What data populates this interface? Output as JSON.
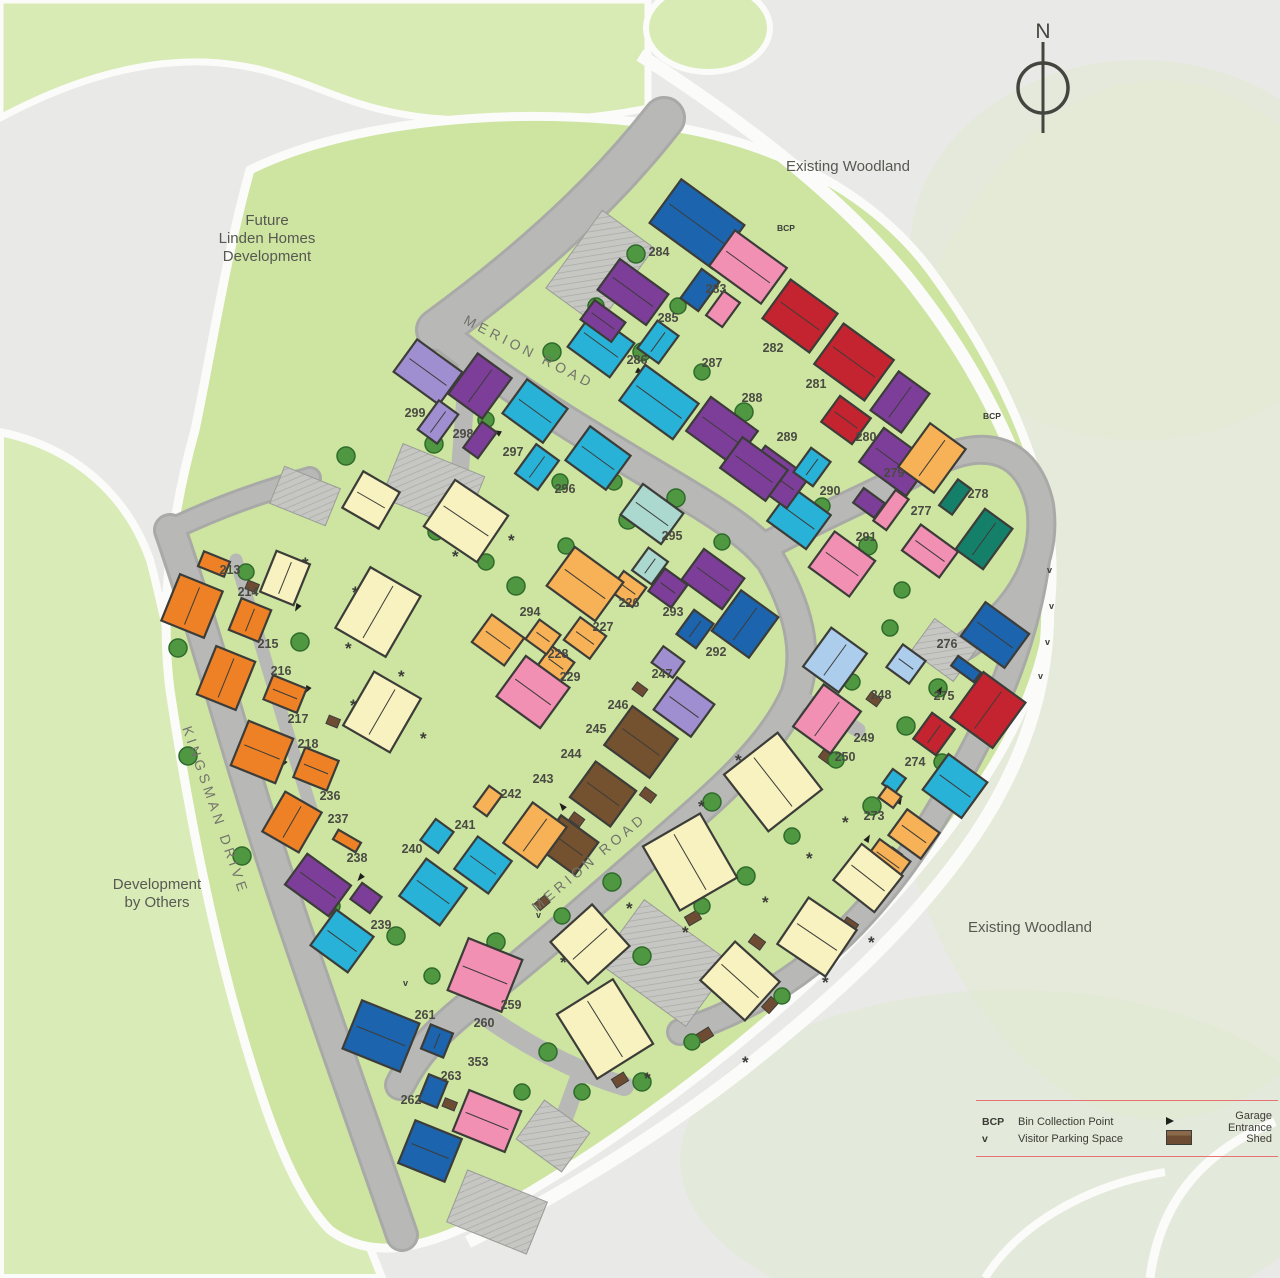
{
  "map": {
    "colors": {
      "orange": "#ee8125",
      "amber": "#f7b157",
      "cream": "#f8f2c0",
      "pink": "#f290b3",
      "red": "#c3242f",
      "purple": "#7c3e99",
      "lavender": "#a08fd0",
      "cyan": "#29b2d8",
      "paleCyan": "#abd9cf",
      "blue": "#1c64ad",
      "lightBlue": "#accdec",
      "teal": "#15806a",
      "brown": "#74512f",
      "road": "#b6b7b4",
      "green_dev": "#cde5a1",
      "green_band": "#d8ebb4",
      "legend_rule": "#e87272"
    },
    "compass": {
      "label": "N"
    },
    "area_labels": [
      {
        "id": "existing-woodland-top",
        "lines": [
          "Existing Woodland"
        ],
        "x": 848,
        "y": 171
      },
      {
        "id": "existing-woodland-right",
        "lines": [
          "Existing Woodland"
        ],
        "x": 1030,
        "y": 932
      },
      {
        "id": "future-linden-homes",
        "lines": [
          "Future",
          "Linden Homes",
          "Development"
        ],
        "x": 267,
        "y": 225
      },
      {
        "id": "development-by-others",
        "lines": [
          "Development",
          "by Others"
        ],
        "x": 157,
        "y": 889
      }
    ],
    "road_labels": [
      {
        "text": "MERION ROAD",
        "x": 527,
        "y": 356,
        "angle": 27
      },
      {
        "text": "MERION ROAD",
        "x": 592,
        "y": 866,
        "angle": -40
      },
      {
        "text": "KINGSMAN DRIVE",
        "x": 211,
        "y": 812,
        "angle": 71
      }
    ],
    "poi_labels": [
      {
        "text": "BCP",
        "x": 992,
        "y": 419
      },
      {
        "text": "BCP",
        "x": 786,
        "y": 231
      }
    ],
    "plot_labels": [
      {
        "n": "213",
        "x": 230,
        "y": 574
      },
      {
        "n": "214",
        "x": 248,
        "y": 596
      },
      {
        "n": "215",
        "x": 268,
        "y": 648
      },
      {
        "n": "216",
        "x": 281,
        "y": 675
      },
      {
        "n": "217",
        "x": 298,
        "y": 723
      },
      {
        "n": "218",
        "x": 308,
        "y": 748
      },
      {
        "n": "226",
        "x": 629,
        "y": 607
      },
      {
        "n": "227",
        "x": 603,
        "y": 631
      },
      {
        "n": "228",
        "x": 558,
        "y": 658
      },
      {
        "n": "229",
        "x": 570,
        "y": 681
      },
      {
        "n": "236",
        "x": 330,
        "y": 800
      },
      {
        "n": "237",
        "x": 338,
        "y": 823
      },
      {
        "n": "238",
        "x": 357,
        "y": 862
      },
      {
        "n": "239",
        "x": 381,
        "y": 929
      },
      {
        "n": "240",
        "x": 412,
        "y": 853
      },
      {
        "n": "241",
        "x": 465,
        "y": 829
      },
      {
        "n": "242",
        "x": 511,
        "y": 798
      },
      {
        "n": "243",
        "x": 543,
        "y": 783
      },
      {
        "n": "244",
        "x": 571,
        "y": 758
      },
      {
        "n": "245",
        "x": 596,
        "y": 733
      },
      {
        "n": "246",
        "x": 618,
        "y": 709
      },
      {
        "n": "247",
        "x": 662,
        "y": 678
      },
      {
        "n": "248",
        "x": 881,
        "y": 699
      },
      {
        "n": "249",
        "x": 864,
        "y": 742
      },
      {
        "n": "250",
        "x": 845,
        "y": 761
      },
      {
        "n": "259",
        "x": 511,
        "y": 1009
      },
      {
        "n": "260",
        "x": 484,
        "y": 1027
      },
      {
        "n": "261",
        "x": 425,
        "y": 1019
      },
      {
        "n": "262",
        "x": 411,
        "y": 1104
      },
      {
        "n": "263",
        "x": 451,
        "y": 1080
      },
      {
        "n": "353",
        "x": 478,
        "y": 1066
      },
      {
        "n": "273",
        "x": 874,
        "y": 820
      },
      {
        "n": "274",
        "x": 915,
        "y": 766
      },
      {
        "n": "275",
        "x": 944,
        "y": 700
      },
      {
        "n": "276",
        "x": 947,
        "y": 648
      },
      {
        "n": "277",
        "x": 921,
        "y": 515
      },
      {
        "n": "278",
        "x": 978,
        "y": 498
      },
      {
        "n": "279",
        "x": 894,
        "y": 477
      },
      {
        "n": "280",
        "x": 866,
        "y": 441
      },
      {
        "n": "281",
        "x": 816,
        "y": 388
      },
      {
        "n": "282",
        "x": 773,
        "y": 352
      },
      {
        "n": "283",
        "x": 716,
        "y": 293
      },
      {
        "n": "284",
        "x": 659,
        "y": 256
      },
      {
        "n": "285",
        "x": 668,
        "y": 322
      },
      {
        "n": "286",
        "x": 637,
        "y": 364
      },
      {
        "n": "287",
        "x": 712,
        "y": 367
      },
      {
        "n": "288",
        "x": 752,
        "y": 402
      },
      {
        "n": "289",
        "x": 787,
        "y": 441
      },
      {
        "n": "290",
        "x": 830,
        "y": 495
      },
      {
        "n": "291",
        "x": 866,
        "y": 541
      },
      {
        "n": "292",
        "x": 716,
        "y": 656
      },
      {
        "n": "293",
        "x": 673,
        "y": 616
      },
      {
        "n": "294",
        "x": 530,
        "y": 616
      },
      {
        "n": "295",
        "x": 672,
        "y": 540
      },
      {
        "n": "296",
        "x": 565,
        "y": 493
      },
      {
        "n": "297",
        "x": 513,
        "y": 456
      },
      {
        "n": "298",
        "x": 463,
        "y": 438
      },
      {
        "n": "299",
        "x": 415,
        "y": 417
      }
    ],
    "houses": [
      {
        "x": 697,
        "y": 224,
        "w": 78,
        "h": 54,
        "r": 36,
        "c": "blue"
      },
      {
        "x": 700,
        "y": 290,
        "w": 22,
        "h": 36,
        "r": 36,
        "c": "blue"
      },
      {
        "x": 723,
        "y": 309,
        "w": 20,
        "h": 30,
        "r": 36,
        "c": "pink"
      },
      {
        "x": 748,
        "y": 267,
        "w": 64,
        "h": 44,
        "r": 36,
        "c": "pink"
      },
      {
        "x": 800,
        "y": 316,
        "w": 58,
        "h": 48,
        "r": 36,
        "c": "red"
      },
      {
        "x": 854,
        "y": 362,
        "w": 62,
        "h": 50,
        "r": 36,
        "c": "red"
      },
      {
        "x": 846,
        "y": 420,
        "w": 38,
        "h": 32,
        "r": 36,
        "c": "red"
      },
      {
        "x": 900,
        "y": 402,
        "w": 38,
        "h": 48,
        "r": 36,
        "c": "purple"
      },
      {
        "x": 895,
        "y": 462,
        "w": 58,
        "h": 42,
        "r": 36,
        "c": "purple"
      },
      {
        "x": 869,
        "y": 503,
        "w": 26,
        "h": 18,
        "r": 36,
        "c": "purple"
      },
      {
        "x": 932,
        "y": 458,
        "w": 44,
        "h": 54,
        "r": 36,
        "c": "amber"
      },
      {
        "x": 955,
        "y": 497,
        "w": 16,
        "h": 32,
        "r": 36,
        "c": "teal"
      },
      {
        "x": 984,
        "y": 539,
        "w": 34,
        "h": 50,
        "r": 36,
        "c": "teal"
      },
      {
        "x": 891,
        "y": 510,
        "w": 16,
        "h": 38,
        "r": 36,
        "c": "pink"
      },
      {
        "x": 930,
        "y": 551,
        "w": 46,
        "h": 32,
        "r": 36,
        "c": "pink"
      },
      {
        "x": 842,
        "y": 564,
        "w": 50,
        "h": 44,
        "r": 36,
        "c": "pink"
      },
      {
        "x": 799,
        "y": 518,
        "w": 48,
        "h": 42,
        "r": 36,
        "c": "cyan"
      },
      {
        "x": 776,
        "y": 477,
        "w": 54,
        "h": 38,
        "r": 36,
        "c": "purple"
      },
      {
        "x": 812,
        "y": 467,
        "w": 24,
        "h": 30,
        "r": 36,
        "c": "cyan"
      },
      {
        "x": 722,
        "y": 431,
        "w": 58,
        "h": 42,
        "r": 36,
        "c": "purple"
      },
      {
        "x": 754,
        "y": 469,
        "w": 56,
        "h": 38,
        "r": 36,
        "c": "purple"
      },
      {
        "x": 659,
        "y": 402,
        "w": 66,
        "h": 44,
        "r": 36,
        "c": "cyan"
      },
      {
        "x": 601,
        "y": 345,
        "w": 52,
        "h": 42,
        "r": 36,
        "c": "cyan"
      },
      {
        "x": 658,
        "y": 342,
        "w": 26,
        "h": 34,
        "r": 36,
        "c": "cyan"
      },
      {
        "x": 633,
        "y": 292,
        "w": 60,
        "h": 38,
        "r": 36,
        "c": "purple"
      },
      {
        "x": 603,
        "y": 321,
        "w": 38,
        "h": 24,
        "r": 36,
        "c": "purple"
      },
      {
        "x": 428,
        "y": 372,
        "w": 56,
        "h": 40,
        "r": 36,
        "c": "lavender"
      },
      {
        "x": 438,
        "y": 422,
        "w": 24,
        "h": 36,
        "r": 36,
        "c": "lavender"
      },
      {
        "x": 480,
        "y": 386,
        "w": 42,
        "h": 50,
        "r": 36,
        "c": "purple"
      },
      {
        "x": 480,
        "y": 440,
        "w": 18,
        "h": 32,
        "r": 36,
        "c": "purple"
      },
      {
        "x": 535,
        "y": 411,
        "w": 50,
        "h": 42,
        "r": 36,
        "c": "cyan"
      },
      {
        "x": 537,
        "y": 467,
        "w": 28,
        "h": 36,
        "r": 36,
        "c": "cyan"
      },
      {
        "x": 598,
        "y": 458,
        "w": 50,
        "h": 42,
        "r": 36,
        "c": "cyan"
      },
      {
        "x": 652,
        "y": 514,
        "w": 50,
        "h": 38,
        "r": 36,
        "c": "paleCyan"
      },
      {
        "x": 650,
        "y": 566,
        "w": 24,
        "h": 28,
        "r": 36,
        "c": "paleCyan"
      },
      {
        "x": 628,
        "y": 589,
        "w": 28,
        "h": 24,
        "r": 36,
        "c": "amber"
      },
      {
        "x": 585,
        "y": 584,
        "w": 60,
        "h": 48,
        "r": 36,
        "c": "amber"
      },
      {
        "x": 585,
        "y": 638,
        "w": 32,
        "h": 28,
        "r": 36,
        "c": "amber"
      },
      {
        "x": 556,
        "y": 664,
        "w": 28,
        "h": 24,
        "r": 36,
        "c": "amber"
      },
      {
        "x": 543,
        "y": 637,
        "w": 26,
        "h": 24,
        "r": 36,
        "c": "amber"
      },
      {
        "x": 533,
        "y": 692,
        "w": 54,
        "h": 50,
        "r": 36,
        "c": "pink"
      },
      {
        "x": 498,
        "y": 640,
        "w": 40,
        "h": 34,
        "r": 36,
        "c": "amber"
      },
      {
        "x": 713,
        "y": 579,
        "w": 50,
        "h": 38,
        "r": 36,
        "c": "purple"
      },
      {
        "x": 668,
        "y": 588,
        "w": 28,
        "h": 28,
        "r": 36,
        "c": "purple"
      },
      {
        "x": 695,
        "y": 629,
        "w": 24,
        "h": 30,
        "r": 36,
        "c": "blue"
      },
      {
        "x": 745,
        "y": 624,
        "w": 46,
        "h": 50,
        "r": 36,
        "c": "blue"
      },
      {
        "x": 668,
        "y": 662,
        "w": 26,
        "h": 20,
        "r": 36,
        "c": "lavender"
      },
      {
        "x": 684,
        "y": 707,
        "w": 46,
        "h": 40,
        "r": 36,
        "c": "lavender"
      },
      {
        "x": 641,
        "y": 742,
        "w": 56,
        "h": 48,
        "r": 36,
        "c": "brown"
      },
      {
        "x": 603,
        "y": 794,
        "w": 50,
        "h": 44,
        "r": 36,
        "c": "brown"
      },
      {
        "x": 568,
        "y": 845,
        "w": 46,
        "h": 40,
        "r": 36,
        "c": "brown"
      },
      {
        "x": 535,
        "y": 835,
        "w": 42,
        "h": 50,
        "r": 36,
        "c": "amber"
      },
      {
        "x": 488,
        "y": 801,
        "w": 16,
        "h": 26,
        "r": 36,
        "c": "amber"
      },
      {
        "x": 437,
        "y": 836,
        "w": 22,
        "h": 26,
        "r": 36,
        "c": "cyan"
      },
      {
        "x": 483,
        "y": 865,
        "w": 42,
        "h": 40,
        "r": 36,
        "c": "cyan"
      },
      {
        "x": 433,
        "y": 892,
        "w": 50,
        "h": 46,
        "r": 36,
        "c": "cyan"
      },
      {
        "x": 342,
        "y": 941,
        "w": 46,
        "h": 44,
        "r": 36,
        "c": "cyan"
      },
      {
        "x": 318,
        "y": 885,
        "w": 54,
        "h": 38,
        "r": 36,
        "c": "purple"
      },
      {
        "x": 366,
        "y": 898,
        "w": 24,
        "h": 20,
        "r": 36,
        "c": "purple"
      },
      {
        "x": 347,
        "y": 841,
        "w": 26,
        "h": 11,
        "r": 30,
        "c": "orange"
      },
      {
        "x": 292,
        "y": 822,
        "w": 42,
        "h": 46,
        "r": 30,
        "c": "orange"
      },
      {
        "x": 214,
        "y": 564,
        "w": 28,
        "h": 16,
        "r": 22,
        "c": "orange"
      },
      {
        "x": 192,
        "y": 606,
        "w": 46,
        "h": 50,
        "r": 22,
        "c": "orange"
      },
      {
        "x": 250,
        "y": 620,
        "w": 32,
        "h": 34,
        "r": 22,
        "c": "orange"
      },
      {
        "x": 226,
        "y": 678,
        "w": 42,
        "h": 52,
        "r": 22,
        "c": "orange"
      },
      {
        "x": 285,
        "y": 694,
        "w": 36,
        "h": 26,
        "r": 22,
        "c": "orange"
      },
      {
        "x": 262,
        "y": 752,
        "w": 48,
        "h": 48,
        "r": 22,
        "c": "orange"
      },
      {
        "x": 316,
        "y": 769,
        "w": 36,
        "h": 32,
        "r": 22,
        "c": "orange"
      },
      {
        "x": 285,
        "y": 578,
        "w": 36,
        "h": 44,
        "r": 22,
        "c": "cream"
      },
      {
        "x": 371,
        "y": 500,
        "w": 42,
        "h": 42,
        "r": 30,
        "c": "cream"
      },
      {
        "x": 466,
        "y": 521,
        "w": 64,
        "h": 56,
        "r": 34,
        "c": "cream"
      },
      {
        "x": 378,
        "y": 612,
        "w": 58,
        "h": 70,
        "r": 30,
        "c": "cream"
      },
      {
        "x": 382,
        "y": 712,
        "w": 54,
        "h": 62,
        "r": 30,
        "c": "cream"
      },
      {
        "x": 835,
        "y": 660,
        "w": 44,
        "h": 48,
        "r": 36,
        "c": "lightBlue"
      },
      {
        "x": 906,
        "y": 664,
        "w": 28,
        "h": 28,
        "r": 36,
        "c": "lightBlue"
      },
      {
        "x": 827,
        "y": 719,
        "w": 46,
        "h": 52,
        "r": 36,
        "c": "pink"
      },
      {
        "x": 934,
        "y": 734,
        "w": 28,
        "h": 32,
        "r": 36,
        "c": "red"
      },
      {
        "x": 988,
        "y": 710,
        "w": 52,
        "h": 56,
        "r": 36,
        "c": "red"
      },
      {
        "x": 955,
        "y": 786,
        "w": 48,
        "h": 44,
        "r": 36,
        "c": "cyan"
      },
      {
        "x": 894,
        "y": 781,
        "w": 16,
        "h": 18,
        "r": 36,
        "c": "cyan"
      },
      {
        "x": 890,
        "y": 797,
        "w": 18,
        "h": 14,
        "r": 36,
        "c": "amber"
      },
      {
        "x": 914,
        "y": 834,
        "w": 40,
        "h": 32,
        "r": 36,
        "c": "amber"
      },
      {
        "x": 888,
        "y": 860,
        "w": 38,
        "h": 24,
        "r": 36,
        "c": "amber"
      },
      {
        "x": 995,
        "y": 635,
        "w": 54,
        "h": 42,
        "r": 36,
        "c": "blue"
      },
      {
        "x": 966,
        "y": 669,
        "w": 28,
        "h": 12,
        "r": 36,
        "c": "blue"
      },
      {
        "x": 773,
        "y": 782,
        "w": 68,
        "h": 72,
        "r": -38,
        "c": "cream"
      },
      {
        "x": 690,
        "y": 862,
        "w": 66,
        "h": 74,
        "r": -30,
        "c": "cream"
      },
      {
        "x": 868,
        "y": 878,
        "w": 52,
        "h": 46,
        "r": 38,
        "c": "cream"
      },
      {
        "x": 590,
        "y": 944,
        "w": 56,
        "h": 56,
        "r": -42,
        "c": "cream"
      },
      {
        "x": 817,
        "y": 937,
        "w": 58,
        "h": 56,
        "r": 34,
        "c": "cream"
      },
      {
        "x": 740,
        "y": 981,
        "w": 52,
        "h": 60,
        "r": -48,
        "c": "cream"
      },
      {
        "x": 605,
        "y": 1029,
        "w": 66,
        "h": 76,
        "r": -32,
        "c": "cream"
      },
      {
        "x": 485,
        "y": 975,
        "w": 58,
        "h": 56,
        "r": 22,
        "c": "pink"
      },
      {
        "x": 381,
        "y": 1036,
        "w": 62,
        "h": 52,
        "r": 22,
        "c": "blue"
      },
      {
        "x": 437,
        "y": 1041,
        "w": 24,
        "h": 26,
        "r": 22,
        "c": "blue"
      },
      {
        "x": 433,
        "y": 1091,
        "w": 20,
        "h": 28,
        "r": 22,
        "c": "blue"
      },
      {
        "x": 430,
        "y": 1151,
        "w": 50,
        "h": 46,
        "r": 22,
        "c": "blue"
      },
      {
        "x": 487,
        "y": 1121,
        "w": 56,
        "h": 44,
        "r": 22,
        "c": "pink"
      }
    ]
  },
  "legend": {
    "rows": [
      {
        "sym1": "BCP",
        "label1": "Bin Collection Point",
        "sym2": "garage-arrow",
        "label2": "Garage Entrance"
      },
      {
        "sym1": "v",
        "label1": "Visitor Parking Space",
        "sym2": "shed",
        "label2": "Shed"
      }
    ]
  }
}
